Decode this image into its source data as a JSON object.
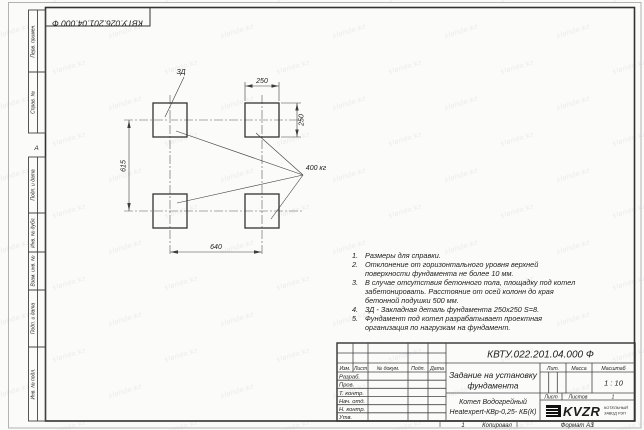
{
  "frame": {
    "top_designation": "КВТУ.026.201.04.000 Ф",
    "zone_marker": "А",
    "left_stamp_labels": [
      "Перв. примен.",
      "Справ. №",
      "Подп. и дата",
      "Инв. № дубл.",
      "Взам. инв. №",
      "Подп. и дата",
      "Инв. № подл."
    ],
    "bottom": {
      "number": "1",
      "copied": "Копировал",
      "format": "Формат А3"
    }
  },
  "watermark": {
    "text": "slando.kz"
  },
  "drawing": {
    "label_zd": "ЗД",
    "label_load": "400 кг",
    "dim_top": "250",
    "dim_right": "250",
    "dim_left": "615",
    "dim_bottom": "640"
  },
  "notes": [
    {
      "num": "1.",
      "text": "Размеры для справки."
    },
    {
      "num": "2.",
      "text": "Отклонение от горизонтального уровня верхней поверхности фундамента не более 10 мм."
    },
    {
      "num": "3.",
      "text": "В случае отсутствия бетонного пола, площадку под котел забетонировать. Расстояние от осей колонн до края бетонной подушки 500 мм."
    },
    {
      "num": "4.",
      "text": "ЗД - Закладная деталь фундамента 250х250 S=8."
    },
    {
      "num": "5.",
      "text": "Фундамент под котел разрабатывает проектная организация по нагрузкам на фундамент."
    }
  ],
  "title_block": {
    "designation": "КВТУ.022.201.04.000 Ф",
    "title_line1": "Задание на установку",
    "title_line2": "фундамента",
    "product_line1": "Котел Водогрейный",
    "product_line2": "Heatexpert-КВр-0,25- КБ(К)",
    "header_cols": [
      "Изм.",
      "Лист",
      "№ докум.",
      "Подп.",
      "Дата"
    ],
    "rows": [
      "Разраб.",
      "Пров.",
      "Т. контр.",
      "Нач. отд.",
      "Н. контр.",
      "Утв."
    ],
    "lit_label": "Лит.",
    "mass_label": "Масса",
    "scale_label": "Масштаб",
    "scale_value": "1 : 10",
    "sheet_label": "Лист",
    "sheets_label": "Листов",
    "sheets_value": "1",
    "logo_text": "KVZR",
    "logo_caption_1": "КОТЕЛЬНЫЙ",
    "logo_caption_2": "ЗАВОД РЭП"
  }
}
